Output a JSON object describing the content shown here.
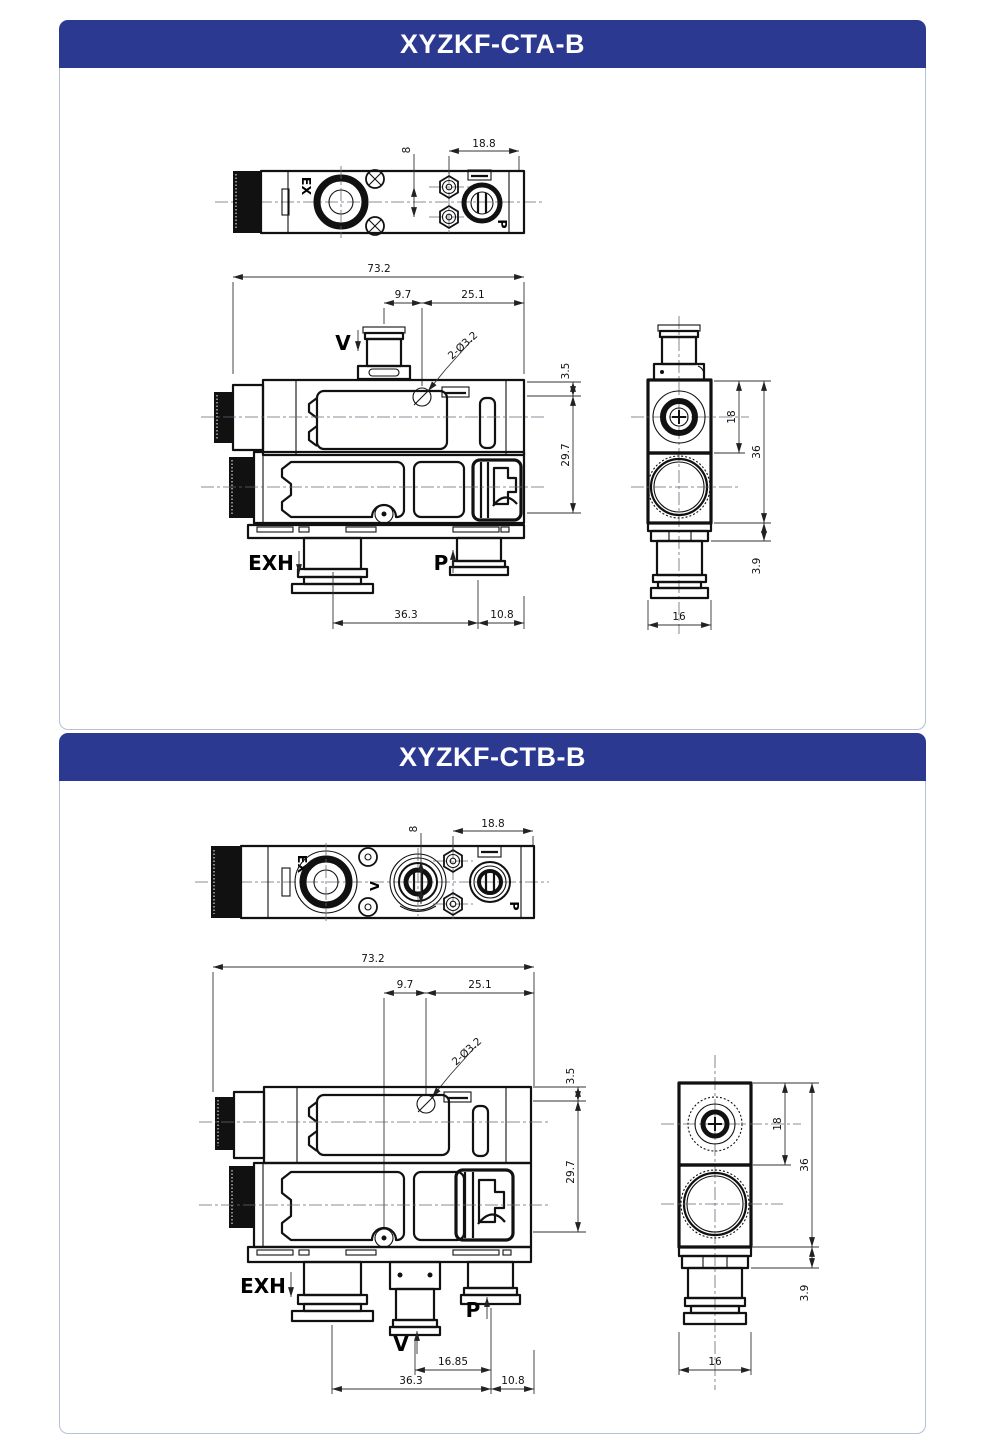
{
  "colors": {
    "header_bg": "#2b3990",
    "header_text": "#ffffff",
    "panel_border": "#b7c0d9",
    "line": "#111111"
  },
  "panels": [
    {
      "title": "XYZKF-CTA-B",
      "top_view": {
        "label_ex": "EX",
        "label_p": "P",
        "dim_height": "8",
        "dim_offset": "18.8"
      },
      "front_view": {
        "label_v": "V",
        "label_exh": "EXH",
        "label_p": "P",
        "label_holes": "2-Ø3.2",
        "dim_width": "73.2",
        "dim_v_offset": "9.7",
        "dim_hole_offset": "25.1",
        "dim_top": "3.5",
        "dim_body": "29.7",
        "dim_exh_p": "36.3",
        "dim_p_edge": "10.8"
      },
      "side_view": {
        "dim_screw": "18",
        "dim_body": "36",
        "dim_plate": "3.9",
        "dim_width": "16"
      }
    },
    {
      "title": "XYZKF-CTB-B",
      "top_view": {
        "label_ex": "EX",
        "label_v": "V",
        "label_p": "P",
        "dim_height": "8",
        "dim_offset": "18.8"
      },
      "front_view": {
        "label_v": "V",
        "label_exh": "EXH",
        "label_p": "P",
        "label_holes": "2-Ø3.2",
        "dim_width": "73.2",
        "dim_v_offset": "9.7",
        "dim_hole_offset": "25.1",
        "dim_top": "3.5",
        "dim_body": "29.7",
        "dim_v_p": "16.85",
        "dim_exh_p": "36.3",
        "dim_p_edge": "10.8"
      },
      "side_view": {
        "dim_screw": "18",
        "dim_body": "36",
        "dim_plate": "3.9",
        "dim_width": "16"
      }
    }
  ]
}
